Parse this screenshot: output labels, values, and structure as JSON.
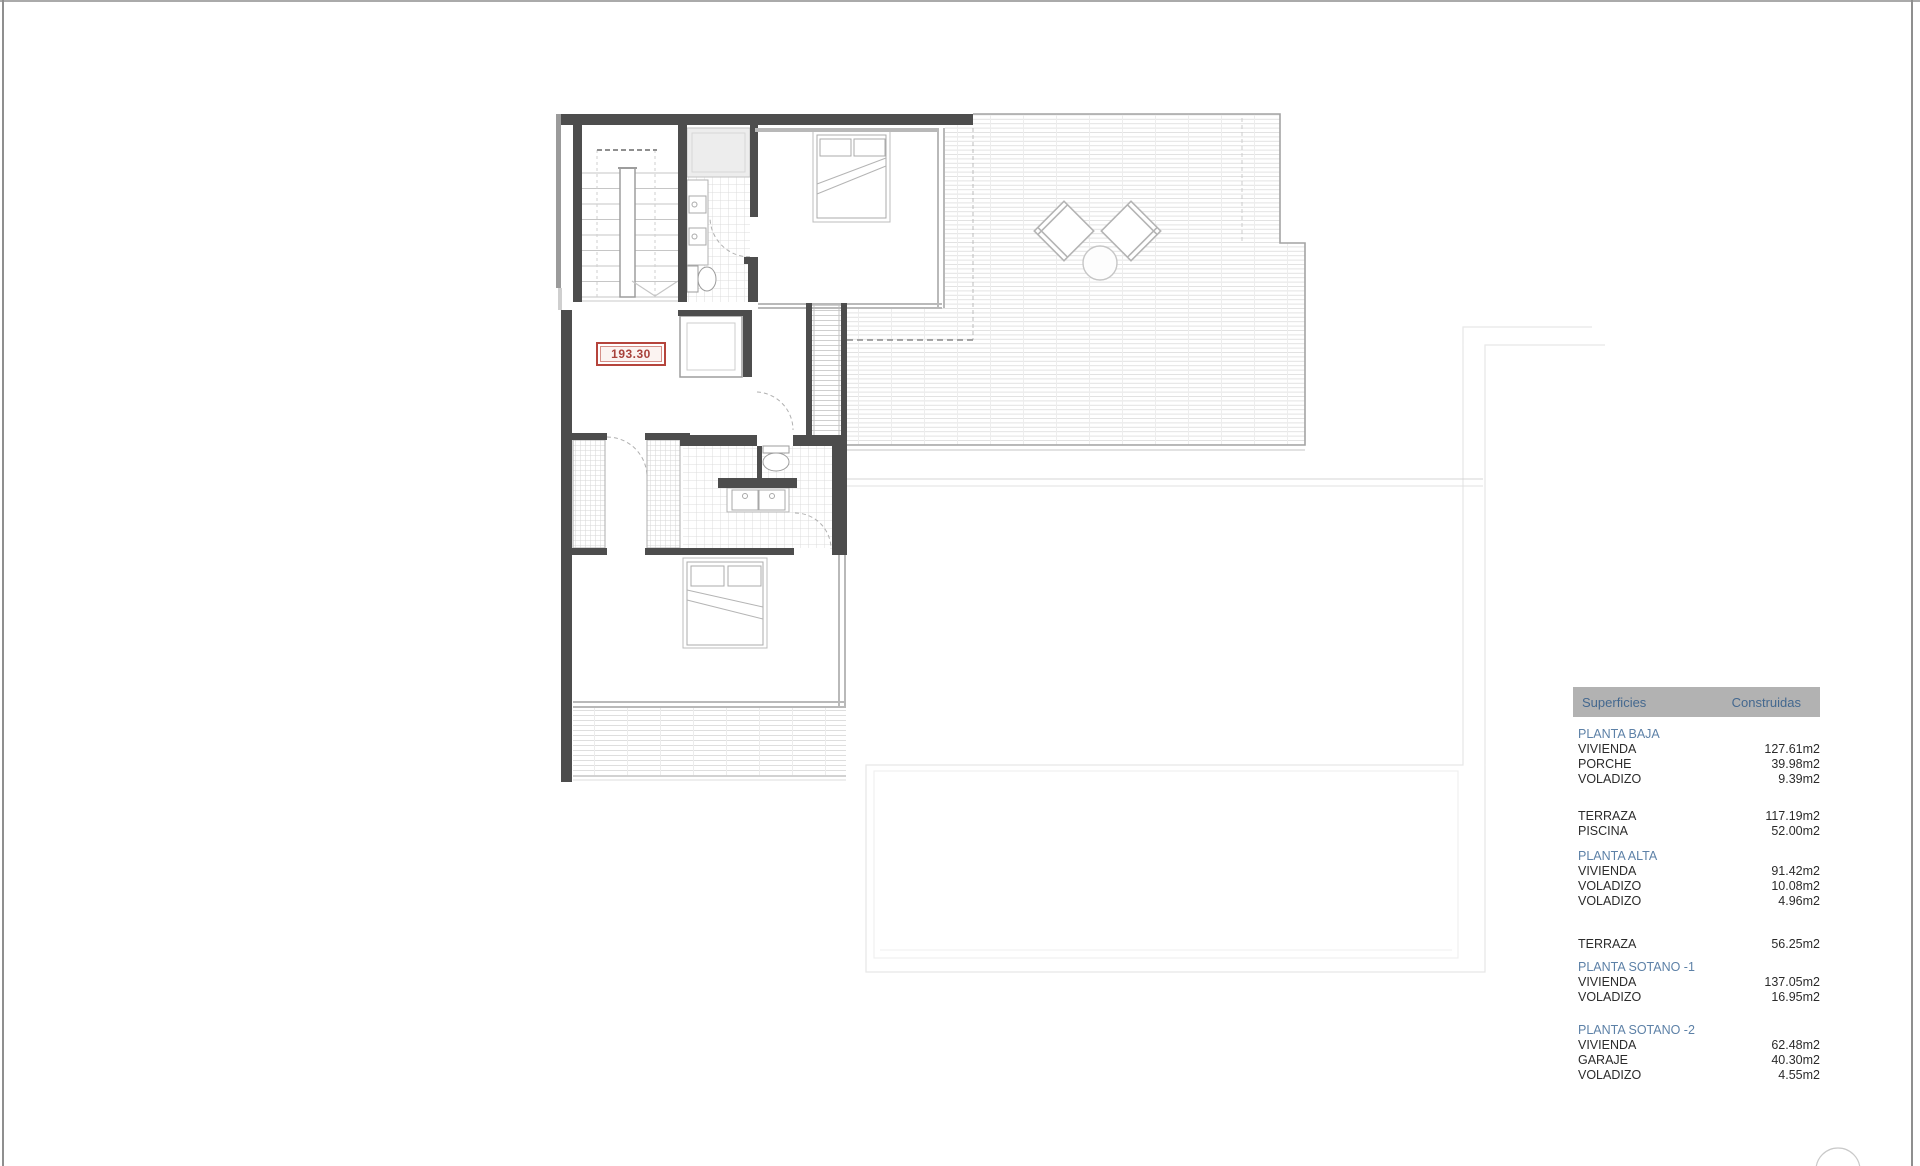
{
  "plan": {
    "area_label": {
      "value": "193.30",
      "color": "#b5443c"
    },
    "icons": [
      "staircase-icon",
      "elevator-icon",
      "shower-icon",
      "sink-icon",
      "toilet-icon",
      "bed-icon",
      "wardrobe-icon",
      "armchair-icon",
      "side-table-icon",
      "terrace-decking",
      "exterior-stairs-icon",
      "door-swing-arc"
    ]
  },
  "table": {
    "header": {
      "col1": "Superficies",
      "col2": "Construidas"
    },
    "groups": [
      {
        "title": "PLANTA BAJA",
        "rows": [
          [
            "VIVIENDA",
            "127.61m2"
          ],
          [
            "PORCHE",
            "39.98m2"
          ],
          [
            "VOLADIZO",
            "9.39m2"
          ]
        ]
      },
      {
        "title": "",
        "rows": [
          [
            "TERRAZA",
            "117.19m2"
          ],
          [
            "PISCINA",
            "52.00m2"
          ]
        ]
      },
      {
        "title": "PLANTA ALTA",
        "rows": [
          [
            "VIVIENDA",
            "91.42m2"
          ],
          [
            "VOLADIZO",
            "10.08m2"
          ],
          [
            "VOLADIZO",
            "4.96m2"
          ]
        ]
      },
      {
        "title": "",
        "rows": [
          [
            "TERRAZA",
            "56.25m2"
          ]
        ]
      },
      {
        "title": "PLANTA SOTANO -1",
        "rows": [
          [
            "VIVIENDA",
            "137.05m2"
          ],
          [
            "VOLADIZO",
            "16.95m2"
          ]
        ]
      },
      {
        "title": "PLANTA SOTANO -2",
        "rows": [
          [
            "VIVIENDA",
            "62.48m2"
          ],
          [
            "GARAJE",
            "40.30m2"
          ],
          [
            "VOLADIZO",
            "4.55m2"
          ]
        ]
      }
    ]
  },
  "colors": {
    "wall": "#4d4d4d",
    "accent_red": "#b5443c",
    "table_header_bg": "#b2b2b2",
    "table_header_text": "#44688f",
    "section_text": "#5d81a7",
    "body_text": "#2b2b2b"
  }
}
